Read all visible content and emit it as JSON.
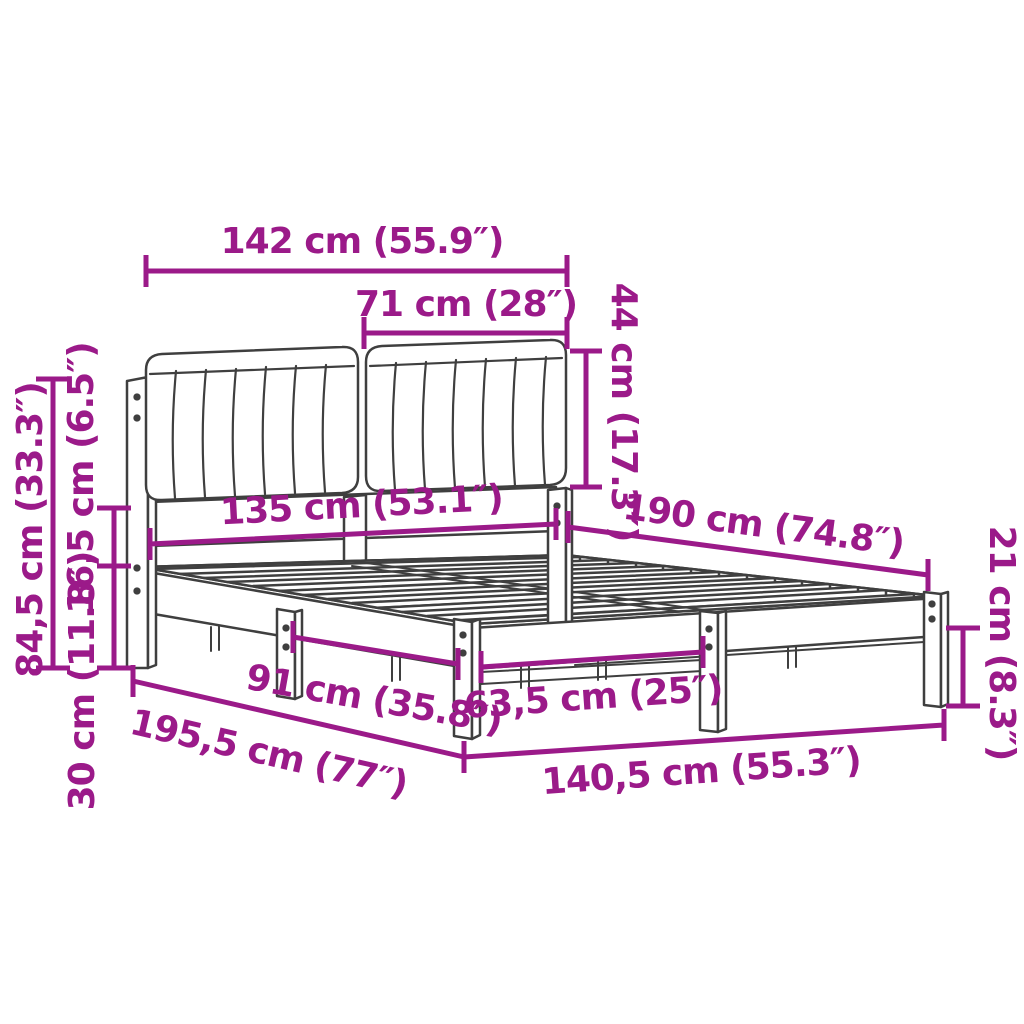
{
  "diagram": {
    "kind": "bed-frame-dimension-diagram",
    "colors": {
      "annotation": "#9B1A89",
      "drawing": "#3F3F3F",
      "background": "#FFFFFF"
    },
    "units": {
      "primary": "cm",
      "secondary": "in"
    },
    "dimensions": {
      "headboard_total_width": {
        "text": "142 cm (55.9″)",
        "cm": "142",
        "in": "55.9"
      },
      "cushion_width": {
        "text": "71 cm (28″)",
        "cm": "71",
        "in": "28"
      },
      "cushion_height": {
        "text": "44 cm (17.3″)",
        "cm": "44",
        "in": "17.3"
      },
      "headboard_frame_width": {
        "text": "135 cm (53.1″)",
        "cm": "135",
        "in": "53.1"
      },
      "mattress_length": {
        "text": "190 cm (74.8″)",
        "cm": "190",
        "in": "74.8"
      },
      "headboard_height": {
        "text": "84,5 cm (33.3″)",
        "cm": "84,5",
        "in": "33.3"
      },
      "cushion_rail_gap": {
        "text": "16,5 cm (6.5″)",
        "cm": "16,5",
        "in": "6.5"
      },
      "rail_floor_height": {
        "text": "30 cm (11.8″)",
        "cm": "30",
        "in": "11.8"
      },
      "side_leg_spacing": {
        "text": "91 cm (35.8″)",
        "cm": "91",
        "in": "35.8"
      },
      "foot_leg_spacing": {
        "text": "63,5 cm (25″)",
        "cm": "63,5",
        "in": "25"
      },
      "frame_total_length": {
        "text": "195,5 cm (77″)",
        "cm": "195,5",
        "in": "77"
      },
      "frame_total_width": {
        "text": "140,5 cm (55.3″)",
        "cm": "140,5",
        "in": "55.3"
      },
      "underbed_clearance": {
        "text": "21 cm (8.3″)",
        "cm": "21",
        "in": "8.3"
      }
    }
  }
}
